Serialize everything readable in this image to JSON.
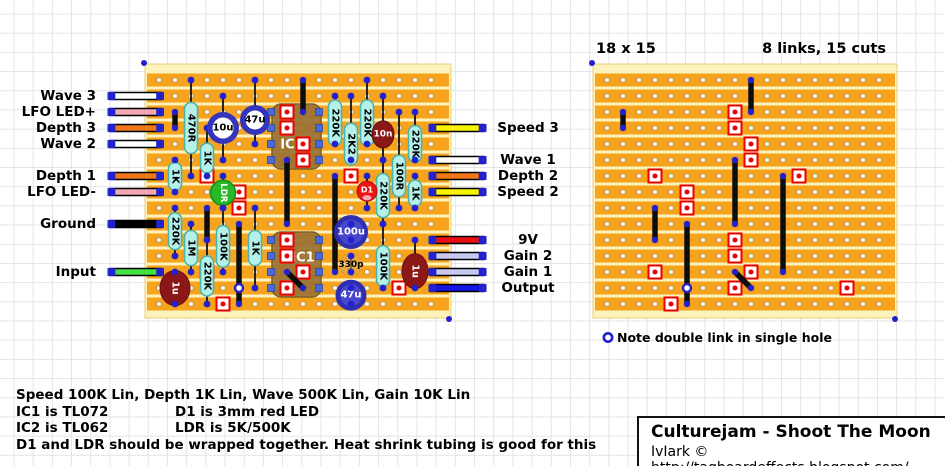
{
  "colors": {
    "strip": "#f6a41e",
    "board_bg": "#fcf2bb",
    "board_border": "#e8cf7a",
    "hole_fill": "#ffffff",
    "hole_ring": "#c9973f",
    "pad_dot": "#2222cc",
    "link": "#0d0d0d",
    "cut_red": "#ee0000",
    "resistor_fill": "#b5f1e9",
    "resistor_stroke": "#4fb3a7",
    "cap_ring": "#3434bc",
    "cap_fill_outer": "#2e2eb2",
    "cap_fill_inner": "#4747cd",
    "ceramic_fill": "rgba(222,170,80,0.55)",
    "ceramic_stroke": "#c89244",
    "ic_fill": "#9a7334",
    "ic_stroke": "#77571d",
    "ic_pad": "#4a6ad4",
    "tantalum": "#8b1717",
    "led_red": "#ee1414",
    "ldr_green": "#28b828",
    "wire_border": "#000000",
    "lead": "#111111"
  },
  "left_board": {
    "grid": {
      "x": 145,
      "y": 64,
      "w": 306,
      "h": 254,
      "hole0x": 159,
      "hole0y": 80,
      "pitch": 16,
      "cols": 18,
      "rows": 15
    },
    "pads_left": [
      {
        "label": "Wave 3",
        "row": 1,
        "color": "#ffffff"
      },
      {
        "label": "LFO LED+",
        "row": 2,
        "color": "#f2a9b4"
      },
      {
        "label": "Depth 3",
        "row": 3,
        "color": "#f07818"
      },
      {
        "label": "Wave 2",
        "row": 4,
        "color": "#ffffff"
      },
      {
        "label": "Depth 1",
        "row": 6,
        "color": "#f07818"
      },
      {
        "label": "LFO LED-",
        "row": 7,
        "color": "#f2a9b4"
      },
      {
        "label": "Ground",
        "row": 9,
        "color": "#000000"
      },
      {
        "label": "Input",
        "row": 12,
        "color": "#42e042"
      }
    ],
    "pads_right": [
      {
        "label": "Speed 3",
        "row": 3,
        "color": "#f8f400"
      },
      {
        "label": "Wave 1",
        "row": 5,
        "color": "#ffffff"
      },
      {
        "label": "Depth 2",
        "row": 6,
        "color": "#f07818"
      },
      {
        "label": "Speed 2",
        "row": 7,
        "color": "#f8f400"
      },
      {
        "label": "9V",
        "row": 10,
        "color": "#ea1010"
      },
      {
        "label": "Gain 2",
        "row": 11,
        "color": "#c8c8f0"
      },
      {
        "label": "Gain 1",
        "row": 12,
        "color": "#c8c8f0"
      },
      {
        "label": "Output",
        "row": 13,
        "color": "#1414e6"
      }
    ],
    "components": [
      {
        "type": "resistor",
        "label": "470R",
        "col": 2,
        "lead": [
          0,
          6
        ],
        "body": [
          1.4,
          4.6
        ]
      },
      {
        "type": "resistor",
        "label": "1K",
        "col": 3,
        "lead": [
          3,
          6
        ],
        "body": [
          3.95,
          5.8
        ]
      },
      {
        "type": "resistor",
        "label": "1K",
        "col": 1,
        "lead": [
          5,
          7
        ],
        "body": [
          5.15,
          6.9
        ]
      },
      {
        "type": "resistor",
        "label": "220K",
        "col": 1,
        "lead": [
          8,
          11
        ],
        "body": [
          8.3,
          10.6
        ]
      },
      {
        "type": "resistor",
        "label": "1M",
        "col": 2,
        "lead": [
          9,
          12
        ],
        "body": [
          9.4,
          11.6
        ]
      },
      {
        "type": "resistor",
        "label": "100K",
        "col": 4,
        "lead": [
          8,
          12
        ],
        "body": [
          9.1,
          11.7
        ]
      },
      {
        "type": "resistor",
        "label": "220K",
        "col": 3,
        "lead": [
          10,
          14
        ],
        "body": [
          11.0,
          13.5
        ]
      },
      {
        "type": "resistor",
        "label": "1K",
        "col": 6,
        "lead": [
          8,
          13
        ],
        "body": [
          9.4,
          11.6
        ]
      },
      {
        "type": "resistor",
        "label": "220K",
        "col": 11,
        "lead": [
          1,
          4
        ],
        "body": [
          1.25,
          4.1
        ]
      },
      {
        "type": "resistor",
        "label": "220K",
        "col": 13,
        "lead": [
          0,
          4
        ],
        "body": [
          1.25,
          4.1
        ]
      },
      {
        "type": "resistor",
        "label": "2K2",
        "col": 12,
        "lead": [
          1,
          5
        ],
        "body": [
          2.7,
          5.3
        ]
      },
      {
        "type": "resistor",
        "label": "220K",
        "col": 16,
        "lead": [
          2,
          5
        ],
        "body": [
          2.85,
          5.15
        ]
      },
      {
        "type": "resistor",
        "label": "220K",
        "col": 14,
        "lead": [
          5,
          9
        ],
        "body": [
          5.85,
          8.6
        ]
      },
      {
        "type": "resistor",
        "label": "100R",
        "col": 15,
        "lead": [
          2,
          8
        ],
        "body": [
          4.7,
          7.3
        ]
      },
      {
        "type": "resistor",
        "label": "1K",
        "col": 16,
        "lead": [
          6,
          8
        ],
        "body": [
          6.25,
          7.9
        ]
      },
      {
        "type": "resistor",
        "label": "100K",
        "col": 14,
        "lead": [
          9,
          13
        ],
        "body": [
          10.35,
          12.9
        ]
      },
      {
        "type": "cap_ring",
        "label": "10u",
        "col": 4,
        "lead": [
          1,
          5
        ],
        "cy": 3.0,
        "r": 16
      },
      {
        "type": "cap_ring",
        "label": "47u",
        "col": 6,
        "lead": [
          0,
          4
        ],
        "cy": 2.5,
        "r": 15
      },
      {
        "type": "cap_fill",
        "label": "100u",
        "col": 12,
        "lead": [
          9,
          10
        ],
        "cy": 9.5,
        "r": 17
      },
      {
        "type": "cap_fill",
        "label": "47u",
        "col": 12,
        "lead": [
          13,
          14
        ],
        "cy": 13.45,
        "r": 15.5
      },
      {
        "type": "cap_ceramic",
        "label": "330p",
        "col": 12,
        "lead": [
          11,
          12
        ],
        "cy": 11.55,
        "r": 11
      },
      {
        "type": "tantalum",
        "label": "1u",
        "col": 1,
        "lead": [
          12,
          14
        ],
        "cy": 13.0,
        "rx": 15,
        "ry": 17.5
      },
      {
        "type": "tantalum",
        "label": "1u",
        "col": 16,
        "lead": [
          10,
          13
        ],
        "cy": 11.95,
        "rx": 13,
        "ry": 17.5
      },
      {
        "type": "film",
        "label": "10n",
        "col": 14,
        "lead": [
          1,
          5
        ],
        "cy": 3.4,
        "rx": 11,
        "ry": 13.5
      },
      {
        "type": "led",
        "label": "D1",
        "col": 13,
        "lead": [
          6,
          8
        ],
        "cy": 6.95,
        "r": 10
      },
      {
        "type": "ldr",
        "label": "LDR",
        "col": 4,
        "lead": [
          6,
          8
        ],
        "cy": 7.05,
        "r": 12.5
      }
    ],
    "ics": [
      {
        "label": "IC2",
        "col_from": 7,
        "col_to": 10,
        "row_from": 2,
        "row_to": 5,
        "label_x": 292,
        "label_y": 145
      },
      {
        "label": "IC1",
        "col_from": 7,
        "col_to": 10,
        "row_from": 10,
        "row_to": 13,
        "label_x": 303,
        "label_y": 258
      }
    ],
    "wires_left_x": [
      110,
      161.5
    ],
    "wires_right_x": [
      431,
      484
    ]
  },
  "right_board": {
    "title_left": "18 x 15",
    "title_right": "8 links, 15 cuts",
    "note": "Note double link in single hole",
    "grid": {
      "x": 593,
      "y": 64,
      "w": 304,
      "h": 254,
      "hole0x": 607,
      "hole0y": 80,
      "pitch": 16,
      "cols": 18,
      "rows": 15
    },
    "note_marker": {
      "x": 608,
      "y": 337.5
    }
  },
  "trace_work": {
    "links": [
      {
        "col": 9,
        "from": 0,
        "to": 2
      },
      {
        "col": 1,
        "from": 2,
        "to": 3
      },
      {
        "col": 8,
        "from": 5,
        "to": 9
      },
      {
        "col": 11,
        "from": 6,
        "to": 12
      },
      {
        "col": 3,
        "from": 8,
        "to": 10
      },
      {
        "col": 5,
        "from": 9,
        "to": 13
      },
      {
        "col": 5,
        "from": 13,
        "to": 14
      }
    ],
    "diagonal_link": {
      "from_col": 8,
      "from_row": 12,
      "to_col": 9,
      "to_row": 13
    },
    "double_link_hole": {
      "col": 5,
      "row": 13
    },
    "cuts": [
      [
        8,
        2
      ],
      [
        8,
        3
      ],
      [
        9,
        4
      ],
      [
        9,
        5
      ],
      [
        3,
        6
      ],
      [
        12,
        6
      ],
      [
        5,
        7
      ],
      [
        5,
        8
      ],
      [
        8,
        10
      ],
      [
        8,
        11
      ],
      [
        3,
        12
      ],
      [
        9,
        12
      ],
      [
        8,
        13
      ],
      [
        15,
        13
      ],
      [
        4,
        14
      ]
    ]
  },
  "notes_block": {
    "line1": "Speed 100K Lin, Depth 1K Lin, Wave 500K Lin, Gain 10K Lin",
    "ic1": "IC1 is TL072",
    "d1": "D1 is 3mm red LED",
    "ic2": "IC2 is TL062",
    "ldr": "LDR is 5K/500K",
    "line4": "D1 and LDR should be wrapped together. Heat shrink tubing is good for this"
  },
  "title_block": {
    "title": "Culturejam - Shoot The Moon",
    "credit": "IvIark © http://tagboardeffects.blogspot.com/"
  }
}
